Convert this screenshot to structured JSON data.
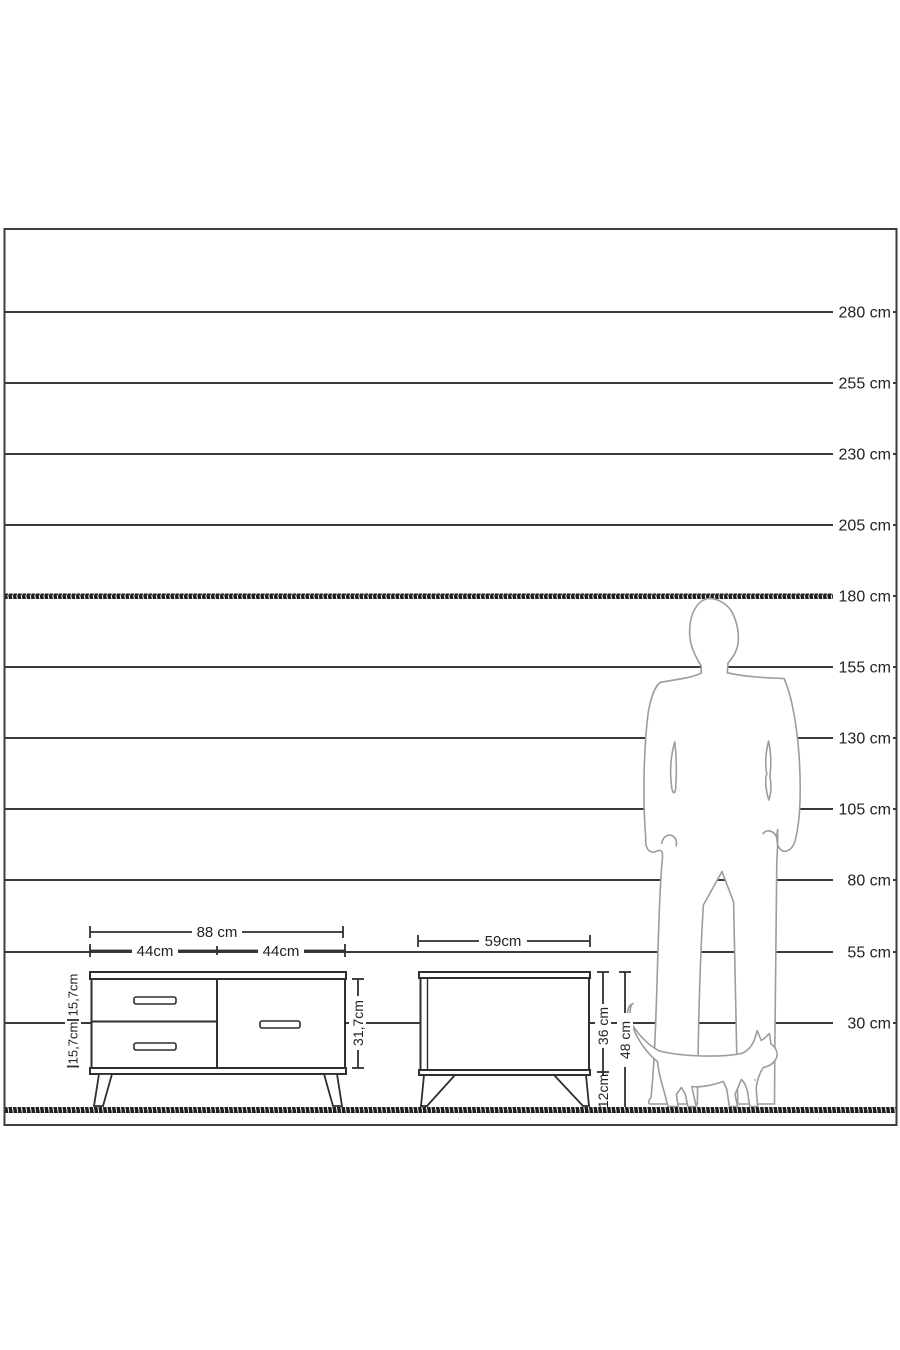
{
  "colors": {
    "background": "#ffffff",
    "scale_line": "#3a3a3a",
    "furniture_line": "#2f2f2f",
    "figure_outline": "#9c9c9c",
    "text": "#222222"
  },
  "height_scale": {
    "unit": "cm",
    "values_cm": [
      280,
      255,
      230,
      205,
      180,
      155,
      130,
      105,
      80,
      55,
      30
    ],
    "labels": [
      "280 cm",
      "255 cm",
      "230 cm",
      "205 cm",
      "180 cm",
      "155 cm",
      "130 cm",
      "105 cm",
      "80 cm",
      "55 cm",
      "30 cm"
    ],
    "highlighted_reference_cm": 180
  },
  "tv_stand": {
    "total_width": "88 cm",
    "left_section_width": "44cm",
    "right_section_width": "44cm",
    "top_drawer_height": "15,7cm",
    "bottom_drawer_height": "15,7cm",
    "body_height": "31,7cm"
  },
  "nightstand": {
    "width": "59cm",
    "body_height": "36 cm",
    "total_height": "48 cm",
    "leg_height": "12cm"
  },
  "figures": {
    "man_icon": "man-silhouette",
    "cat_icon": "cat-silhouette"
  }
}
